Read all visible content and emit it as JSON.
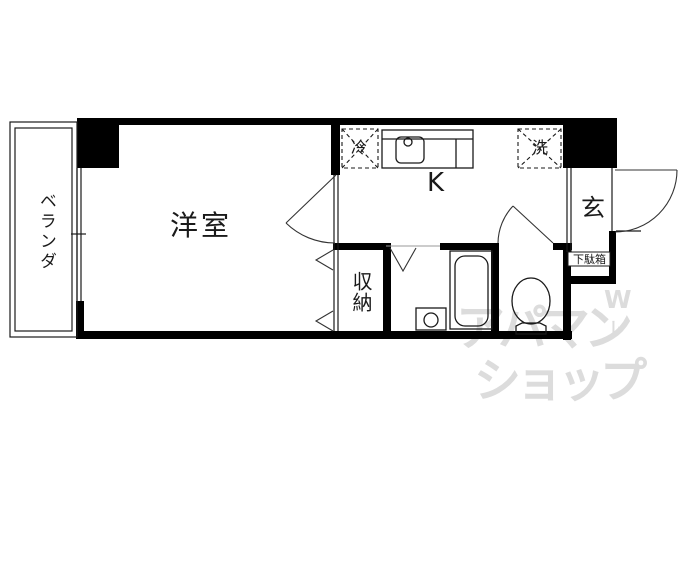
{
  "floor_plan": {
    "labels": {
      "balcony": "ベランダ",
      "western_room": "洋室",
      "kitchen": "K",
      "entrance": "玄",
      "closet": "収納",
      "shoe_cabinet": "下駄箱",
      "refrigerator": "冷",
      "washing_machine": "洗"
    },
    "watermark": {
      "line1": "アパマン",
      "line2": "ショップ",
      "mark_w": "W",
      "mark_l": "ﾚ"
    },
    "colors": {
      "wall": "#000000",
      "line": "#1a1a1a",
      "watermark": "#dcdcdc",
      "background": "#ffffff"
    }
  }
}
